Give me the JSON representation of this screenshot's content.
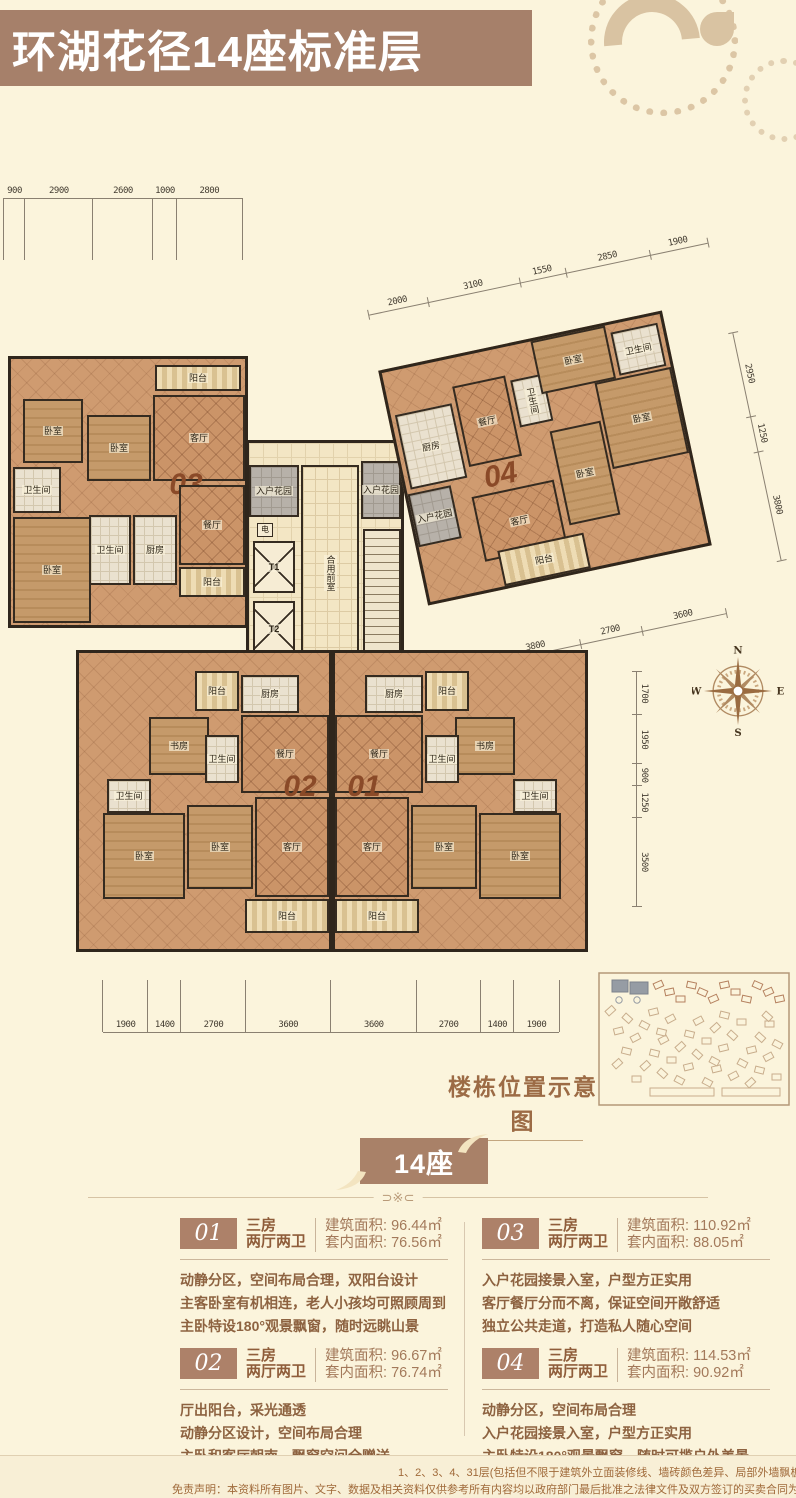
{
  "header": {
    "title": "环湖花径14座标准层"
  },
  "floorplan": {
    "units": [
      {
        "id": "unit-03",
        "label": "03",
        "rooms": [
          {
            "name": "balcony",
            "label": "阳台",
            "kind": "balcony",
            "x": 144,
            "y": 6,
            "w": 86,
            "h": 26
          },
          {
            "name": "bedroom",
            "label": "卧室",
            "kind": "wood",
            "x": 12,
            "y": 40,
            "w": 60,
            "h": 64
          },
          {
            "name": "bedroom",
            "label": "卧室",
            "kind": "wood",
            "x": 76,
            "y": 56,
            "w": 64,
            "h": 66
          },
          {
            "name": "living-room",
            "label": "客厅",
            "kind": "living",
            "x": 142,
            "y": 36,
            "w": 92,
            "h": 86
          },
          {
            "name": "bathroom",
            "label": "卫生间",
            "kind": "tile",
            "x": 2,
            "y": 108,
            "w": 48,
            "h": 46
          },
          {
            "name": "unit-number",
            "label": "03",
            "kind": "none",
            "big": true,
            "x": 150,
            "y": 110,
            "w": 50,
            "h": 32
          },
          {
            "name": "dining-room",
            "label": "餐厅",
            "kind": "living",
            "x": 168,
            "y": 126,
            "w": 66,
            "h": 80
          },
          {
            "name": "bathroom",
            "label": "卫生间",
            "kind": "tile",
            "x": 78,
            "y": 156,
            "w": 42,
            "h": 70
          },
          {
            "name": "kitchen",
            "label": "厨房",
            "kind": "tile",
            "x": 122,
            "y": 156,
            "w": 44,
            "h": 70
          },
          {
            "name": "bedroom",
            "label": "卧室",
            "kind": "wood",
            "x": 2,
            "y": 158,
            "w": 78,
            "h": 106
          },
          {
            "name": "balcony",
            "label": "阳台",
            "kind": "balcony",
            "x": 168,
            "y": 208,
            "w": 66,
            "h": 30
          }
        ]
      },
      {
        "id": "unit-04",
        "label": "04",
        "rooms": [
          {
            "name": "entry-garden",
            "label": "入户花园",
            "kind": "gray",
            "x": 0,
            "y": 124,
            "w": 44,
            "h": 54
          },
          {
            "name": "kitchen",
            "label": "厨房",
            "kind": "tile",
            "x": 4,
            "y": 44,
            "w": 58,
            "h": 76
          },
          {
            "name": "dining-room",
            "label": "餐厅",
            "kind": "living",
            "x": 66,
            "y": 28,
            "w": 54,
            "h": 82
          },
          {
            "name": "unit-number",
            "label": "04",
            "kind": "none",
            "big": true,
            "x": 70,
            "y": 112,
            "w": 50,
            "h": 26
          },
          {
            "name": "bathroom",
            "label": "卫生间",
            "kind": "tile",
            "x": 124,
            "y": 34,
            "w": 34,
            "h": 48,
            "vert": true
          },
          {
            "name": "bedroom",
            "label": "卧室",
            "kind": "wood",
            "x": 152,
            "y": 0,
            "w": 76,
            "h": 54
          },
          {
            "name": "bathroom",
            "label": "卫生间",
            "kind": "tile",
            "x": 232,
            "y": 8,
            "w": 48,
            "h": 44
          },
          {
            "name": "bedroom",
            "label": "卧室",
            "kind": "wood",
            "x": 206,
            "y": 54,
            "w": 78,
            "h": 88
          },
          {
            "name": "living-room",
            "label": "客厅",
            "kind": "living",
            "x": 62,
            "y": 140,
            "w": 84,
            "h": 66
          },
          {
            "name": "bedroom",
            "label": "卧室",
            "kind": "wood",
            "x": 152,
            "y": 92,
            "w": 52,
            "h": 96
          },
          {
            "name": "balcony",
            "label": "阳台",
            "kind": "balcony",
            "x": 76,
            "y": 198,
            "w": 88,
            "h": 36
          }
        ]
      },
      {
        "id": "core",
        "label": "",
        "rooms": [
          {
            "name": "entry-garden",
            "label": "入户花园",
            "kind": "gray",
            "x": 0,
            "y": 22,
            "w": 50,
            "h": 52
          },
          {
            "name": "entry-garden",
            "label": "入户花园",
            "kind": "gray",
            "x": 112,
            "y": 18,
            "w": 40,
            "h": 58
          },
          {
            "name": "shaft",
            "label": "电",
            "kind": "shaft",
            "x": 8,
            "y": 80,
            "w": 16,
            "h": 14
          },
          {
            "name": "elevator",
            "label": "T1",
            "kind": "elevator",
            "x": 4,
            "y": 98,
            "w": 42,
            "h": 52
          },
          {
            "name": "elevator",
            "label": "T2",
            "kind": "elevator",
            "x": 4,
            "y": 158,
            "w": 42,
            "h": 56
          },
          {
            "name": "shaft",
            "label": "水",
            "kind": "shaft",
            "x": 8,
            "y": 220,
            "w": 16,
            "h": 14
          },
          {
            "name": "shared-vestibule",
            "label": "合用前室",
            "kind": "pale",
            "x": 52,
            "y": 22,
            "w": 58,
            "h": 216,
            "vert": true
          },
          {
            "name": "stairs",
            "label": "",
            "kind": "stairs",
            "x": 114,
            "y": 86,
            "w": 38,
            "h": 124
          }
        ]
      },
      {
        "id": "lobby",
        "label": "",
        "rooms": [
          {
            "name": "elevator-lobby",
            "label": "候梯厅",
            "kind": "pale",
            "x": 0,
            "y": 0,
            "w": 56,
            "h": 52,
            "vert": true
          }
        ]
      },
      {
        "id": "unit-02",
        "label": "02",
        "rooms": [
          {
            "name": "balcony",
            "label": "阳台",
            "kind": "balcony",
            "x": 116,
            "y": 18,
            "w": 44,
            "h": 40
          },
          {
            "name": "kitchen",
            "label": "厨房",
            "kind": "tile",
            "x": 162,
            "y": 22,
            "w": 58,
            "h": 38
          },
          {
            "name": "dining-room",
            "label": "餐厅",
            "kind": "living",
            "x": 162,
            "y": 62,
            "w": 88,
            "h": 78
          },
          {
            "name": "study",
            "label": "书房",
            "kind": "wood",
            "x": 70,
            "y": 64,
            "w": 60,
            "h": 58
          },
          {
            "name": "bathroom",
            "label": "卫生间",
            "kind": "tile",
            "x": 126,
            "y": 82,
            "w": 34,
            "h": 48
          },
          {
            "name": "bathroom",
            "label": "卫生间",
            "kind": "tile",
            "x": 28,
            "y": 126,
            "w": 44,
            "h": 34
          },
          {
            "name": "bedroom",
            "label": "卧室",
            "kind": "wood",
            "x": 24,
            "y": 160,
            "w": 82,
            "h": 86
          },
          {
            "name": "bedroom",
            "label": "卧室",
            "kind": "wood",
            "x": 108,
            "y": 152,
            "w": 66,
            "h": 84
          },
          {
            "name": "unit-number",
            "label": "02",
            "kind": "none",
            "big": true,
            "x": 194,
            "y": 118,
            "w": 54,
            "h": 32
          },
          {
            "name": "living-room",
            "label": "客厅",
            "kind": "living",
            "x": 176,
            "y": 144,
            "w": 74,
            "h": 100
          },
          {
            "name": "balcony",
            "label": "阳台",
            "kind": "balcony",
            "x": 166,
            "y": 246,
            "w": 84,
            "h": 34
          }
        ]
      },
      {
        "id": "unit-01",
        "label": "01",
        "mirror": true,
        "rooms": [
          {
            "name": "balcony",
            "label": "阳台",
            "kind": "balcony",
            "x": 116,
            "y": 18,
            "w": 44,
            "h": 40
          },
          {
            "name": "kitchen",
            "label": "厨房",
            "kind": "tile",
            "x": 162,
            "y": 22,
            "w": 58,
            "h": 38
          },
          {
            "name": "dining-room",
            "label": "餐厅",
            "kind": "living",
            "x": 162,
            "y": 62,
            "w": 88,
            "h": 78
          },
          {
            "name": "study",
            "label": "书房",
            "kind": "wood",
            "x": 70,
            "y": 64,
            "w": 60,
            "h": 58
          },
          {
            "name": "bathroom",
            "label": "卫生间",
            "kind": "tile",
            "x": 126,
            "y": 82,
            "w": 34,
            "h": 48
          },
          {
            "name": "bathroom",
            "label": "卫生间",
            "kind": "tile",
            "x": 28,
            "y": 126,
            "w": 44,
            "h": 34
          },
          {
            "name": "bedroom",
            "label": "卧室",
            "kind": "wood",
            "x": 24,
            "y": 160,
            "w": 82,
            "h": 86
          },
          {
            "name": "bedroom",
            "label": "卧室",
            "kind": "wood",
            "x": 108,
            "y": 152,
            "w": 66,
            "h": 84
          },
          {
            "name": "unit-number",
            "label": "01",
            "kind": "none",
            "big": true,
            "x": 194,
            "y": 118,
            "w": 54,
            "h": 32
          },
          {
            "name": "living-room",
            "label": "客厅",
            "kind": "living",
            "x": 176,
            "y": 144,
            "w": 74,
            "h": 100
          },
          {
            "name": "balcony",
            "label": "阳台",
            "kind": "balcony",
            "x": 166,
            "y": 246,
            "w": 84,
            "h": 34
          }
        ]
      }
    ],
    "dimensions": {
      "top_left": [
        900,
        2900,
        2600,
        1000,
        2800
      ],
      "unit04_top": [
        2000,
        3100,
        1550,
        2850,
        1900
      ],
      "unit04_right": [
        2950,
        1250,
        3800
      ],
      "unit04_bottom": [
        3800,
        2700,
        3600
      ],
      "right": [
        1700,
        1950,
        900,
        1250,
        3500
      ],
      "bottom": [
        1900,
        1400,
        2700,
        3600,
        3600,
        2700,
        1400,
        1900
      ]
    },
    "compass": {
      "n": "N",
      "e": "E",
      "s": "S",
      "w": "W"
    }
  },
  "site_diagram": {
    "label": "楼栋位置示意图"
  },
  "section_badge": {
    "label": "14座"
  },
  "divider": {
    "ornament": "⊃※⊂"
  },
  "units_info": [
    {
      "number": "01",
      "type_line1": "三房",
      "type_line2": "两厅两卫",
      "built_area_label": "建筑面积:",
      "built_area": "96.44㎡",
      "inner_area_label": "套内面积:",
      "inner_area": "76.56㎡",
      "desc": [
        "动静分区，空间布局合理，双阳台设计",
        "主客卧室有机相连，老人小孩均可照顾周到",
        "主卧特设180°观景飘窗，随时远眺山景"
      ]
    },
    {
      "number": "02",
      "type_line1": "三房",
      "type_line2": "两厅两卫",
      "built_area_label": "建筑面积:",
      "built_area": "96.67㎡",
      "inner_area_label": "套内面积:",
      "inner_area": "76.74㎡",
      "desc": [
        "厅出阳台，采光通透",
        "动静分区设计，空间布局合理",
        "主卧和客厅朝南，飘窗空间全赠送"
      ]
    },
    {
      "number": "03",
      "type_line1": "三房",
      "type_line2": "两厅两卫",
      "built_area_label": "建筑面积:",
      "built_area": "110.92㎡",
      "inner_area_label": "套内面积:",
      "inner_area": "88.05㎡",
      "desc": [
        "入户花园接景入室，户型方正实用",
        "客厅餐厅分而不离，保证空间开敞舒适",
        "独立公共走道，打造私人随心空间"
      ]
    },
    {
      "number": "04",
      "type_line1": "三房",
      "type_line2": "两厅两卫",
      "built_area_label": "建筑面积:",
      "built_area": "114.53㎡",
      "inner_area_label": "套内面积:",
      "inner_area": "90.92㎡",
      "desc": [
        "动静分区，空间布局合理",
        "入户花园接景入室，户型方正实用",
        "主卧特设180°观景飘窗，随时可揽户外美景"
      ]
    }
  ],
  "footer": {
    "line1": "1、2、3、4、31层(包括但不限于建筑外立面装修线、墙砖颜色差异、局部外墙飘板、首层入户大堂",
    "line2": "免责声明：本资料所有图片、文字、数据及相关资料仅供参考所有内容均以政府部门最后批准之法律文件及双方签订的买卖合同为准，开发商保"
  },
  "colors": {
    "header_brown": "#a6806a",
    "badge_brown": "#ad8169",
    "text_brown": "#8d6240",
    "cream": "#fbf4dc",
    "ornament_tan": "#d9c3a2"
  }
}
